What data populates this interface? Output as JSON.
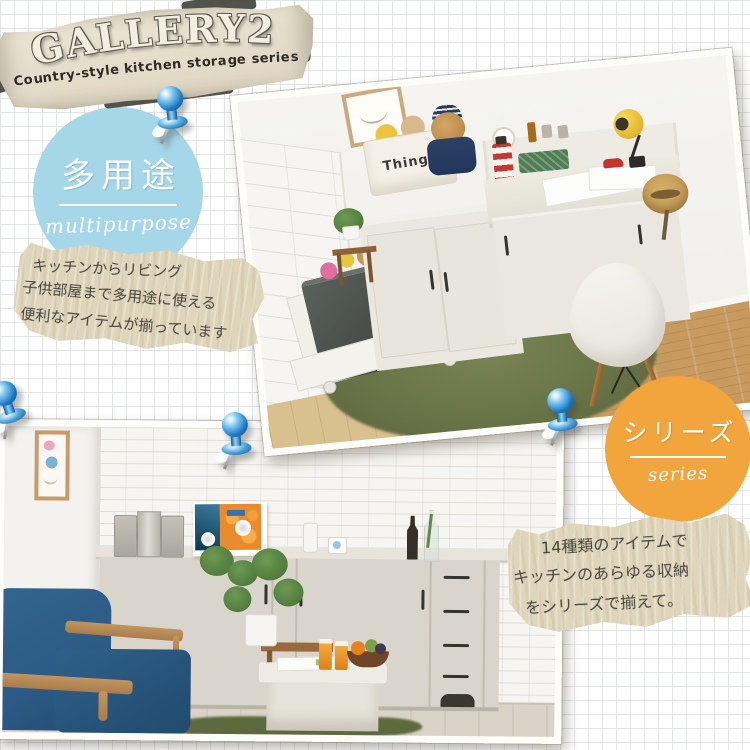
{
  "banner": {
    "title": "GALLERY2",
    "subtitle": "Country-style kitchen storage series"
  },
  "badges": {
    "multipurpose": {
      "jp": "多用途",
      "en": "multipurpose"
    },
    "series": {
      "jp": "シリーズ",
      "en": "series"
    }
  },
  "notes": {
    "multipurpose_note": {
      "lines": [
        "キッチンからリビング",
        "子供部屋まで多用途に使える",
        "便利なアイテムが揃っています"
      ]
    },
    "series_note": {
      "lines": [
        "14種類のアイテムで",
        "キッチンのあらゆる収納",
        "をシリーズで揃えて。"
      ]
    }
  },
  "photo_top": {
    "things_bin_label": "Things"
  },
  "colors": {
    "badge_blue": "#a6d7e8",
    "badge_orange": "#f2a53c",
    "note_beige": "#ded5ba",
    "banner_parchment": "#e9e2d1",
    "banner_ink": "#3c3a33",
    "pin_blue": "#1d77c4",
    "rug_green": "#6b744a",
    "sofa_navy": "#2c5a84",
    "grid_line": "#e3e4e4"
  }
}
